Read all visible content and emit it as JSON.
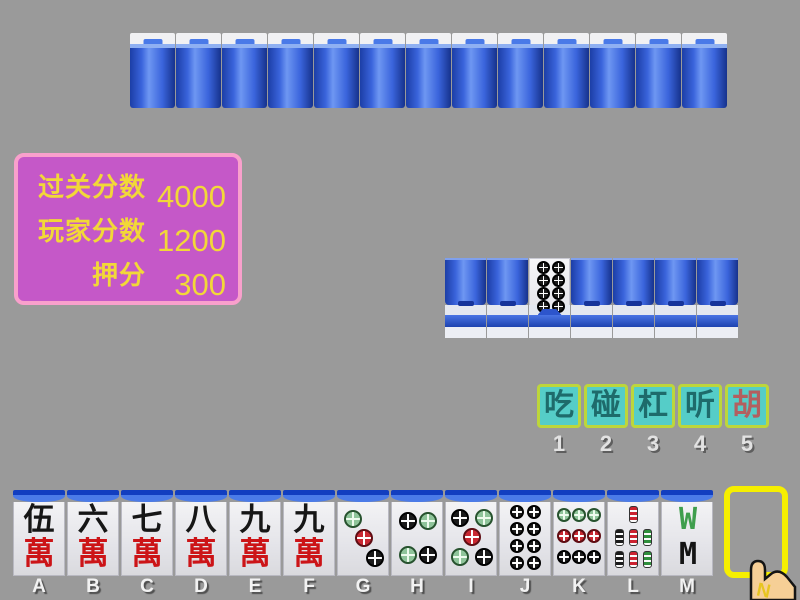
{
  "window": {
    "background": "#9a9a9a"
  },
  "score_panel": {
    "fill": "#c558c8",
    "border": "#f9a0cc",
    "text_color": "#f2d838",
    "rows": [
      {
        "label": "过关分数",
        "value": "4000"
      },
      {
        "label": "玩家分数",
        "value": "1200"
      },
      {
        "label": "押分",
        "value": "300"
      }
    ]
  },
  "opponent_hand": {
    "count": 13,
    "type": "face-down"
  },
  "meld_row": {
    "tiles": [
      {
        "face": "back"
      },
      {
        "face": "back"
      },
      {
        "face": "dots-8",
        "name": "eight-dots"
      },
      {
        "face": "back"
      },
      {
        "face": "back"
      },
      {
        "face": "back"
      },
      {
        "face": "back"
      }
    ]
  },
  "action_bar": {
    "fill": "#55cdc8",
    "border": "#bdd63b",
    "buttons": [
      {
        "label": "吃",
        "hotkey": "1",
        "text_color": "#1e6b6b"
      },
      {
        "label": "碰",
        "hotkey": "2",
        "text_color": "#1e6b6b"
      },
      {
        "label": "杠",
        "hotkey": "3",
        "text_color": "#1e6b6b"
      },
      {
        "label": "听",
        "hotkey": "4",
        "text_color": "#1e6b6b"
      },
      {
        "label": "胡",
        "hotkey": "5",
        "text_color": "#b35f5f"
      }
    ]
  },
  "player_hand": {
    "tiles": [
      {
        "key": "A",
        "face": "wan-5",
        "top": "伍",
        "bottom": "萬"
      },
      {
        "key": "B",
        "face": "wan-6",
        "top": "六",
        "bottom": "萬"
      },
      {
        "key": "C",
        "face": "wan-7",
        "top": "七",
        "bottom": "萬"
      },
      {
        "key": "D",
        "face": "wan-8",
        "top": "八",
        "bottom": "萬"
      },
      {
        "key": "E",
        "face": "wan-9",
        "top": "九",
        "bottom": "萬"
      },
      {
        "key": "F",
        "face": "wan-9",
        "top": "九",
        "bottom": "萬"
      },
      {
        "key": "G",
        "face": "dots-3"
      },
      {
        "key": "H",
        "face": "dots-4"
      },
      {
        "key": "I",
        "face": "dots-5"
      },
      {
        "key": "J",
        "face": "dots-8"
      },
      {
        "key": "K",
        "face": "dots-9"
      },
      {
        "key": "L",
        "face": "bamboo-7"
      },
      {
        "key": "M",
        "face": "bamboo-8",
        "top_glyph": "W",
        "bottom_glyph": "M"
      }
    ]
  },
  "draw_slot": {
    "highlight_color": "#f6ef00",
    "empty": true
  },
  "cursor": {
    "label": "N"
  }
}
